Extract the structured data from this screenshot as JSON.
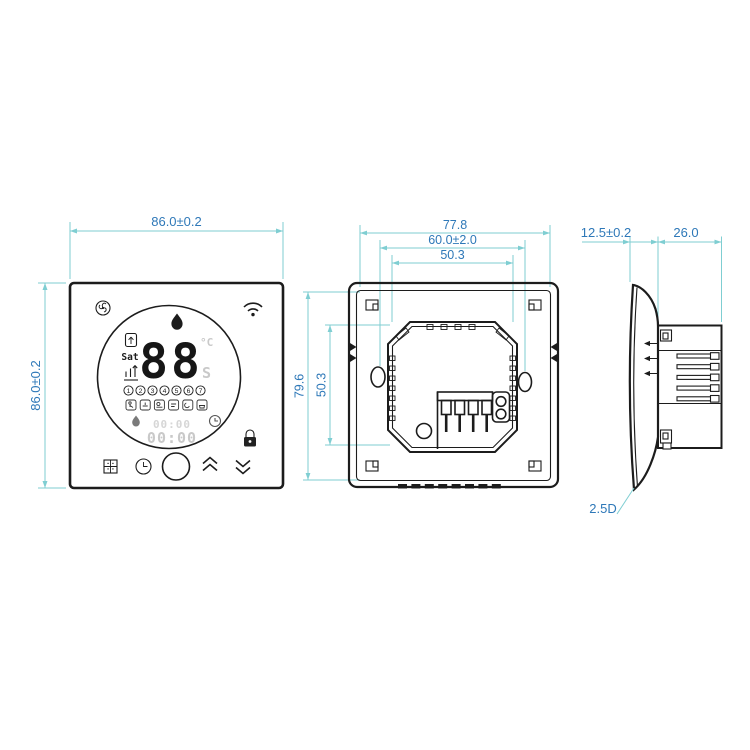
{
  "drawing_type": "thermostat-dimension-drawing",
  "colors": {
    "dimension_line": "#7fced2",
    "dimension_text": "#2e78b8",
    "ink": "#1c1c1c",
    "faint_display": "#c9c9c9",
    "background": "#ffffff"
  },
  "front_view": {
    "width_dim": "86.0±0.2",
    "height_dim": "86.0±0.2",
    "display": {
      "temp": "88",
      "unit": "°C",
      "set_flag": "S",
      "day": "Sat",
      "periods": [
        "1",
        "2",
        "3",
        "4",
        "5",
        "6",
        "7"
      ],
      "time_small": "00:00",
      "time_large": "00:00"
    }
  },
  "back_view": {
    "overall_width_dim": "77.8",
    "mount_spacing_dim": "60.0±2.0",
    "inner_width_dim": "50.3",
    "overall_height_dim": "79.6",
    "inner_height_dim": "50.3"
  },
  "side_view": {
    "panel_depth_dim": "12.5±0.2",
    "box_depth_dim": "26.0",
    "glass_curve_label": "2.5D"
  },
  "icons": {
    "front": [
      "eco-swirl-icon",
      "wifi-icon",
      "flame-icon",
      "valve-icon",
      "program-steps-icon",
      "period-icons",
      "lock-icon",
      "flame-small-icon",
      "clock-small-icon",
      "grid-icon",
      "clock-icon",
      "power-button-icon",
      "chevron-up-icon",
      "chevron-down-icon"
    ]
  }
}
